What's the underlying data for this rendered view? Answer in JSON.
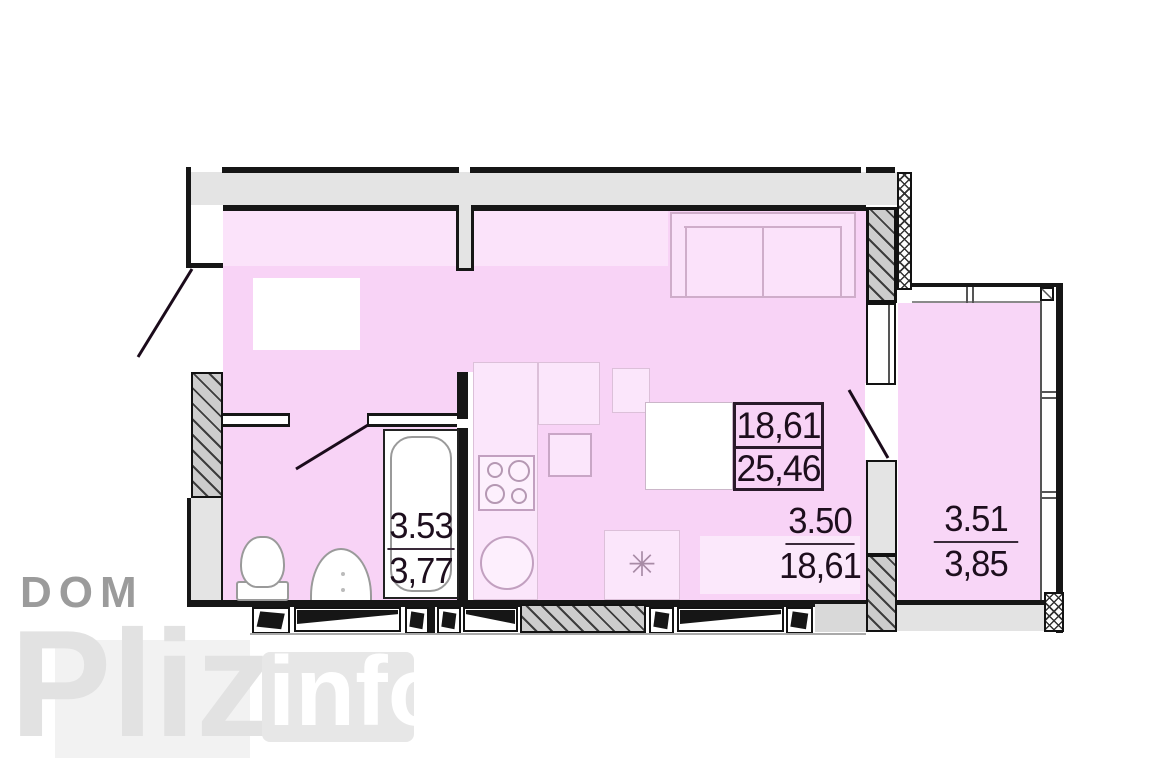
{
  "watermark": {
    "dom": "DOM",
    "pliz": "Pliz",
    "info": "info"
  },
  "summary": {
    "living_area": "18,61",
    "total_area": "25,46"
  },
  "rooms": {
    "main": {
      "number": "3.50",
      "area": "18,61"
    },
    "balcony": {
      "number": "3.51",
      "area": "3,85"
    },
    "bathroom": {
      "number": "3.53",
      "area": "3,77"
    }
  },
  "icons": {
    "fridge": "✳"
  },
  "colors": {
    "room_fill": "#f8d3f6",
    "room_fill_light": "#fbe3fa",
    "wall_gray": "#e4e4e4",
    "wall_line": "#161616",
    "label_text": "#1d0e1d",
    "watermark_gray": "#9b9b9b",
    "watermark_light": "#e2e2e2"
  }
}
